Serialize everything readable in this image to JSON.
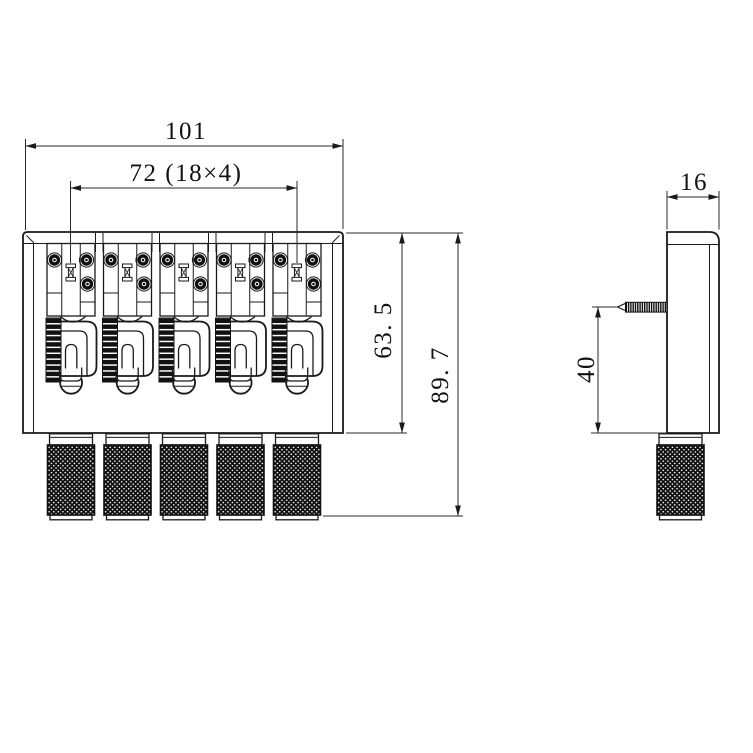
{
  "drawing": {
    "description": "Dimensioned engineering drawing of a 5-string bass guitar bridge, front and side orthographic views",
    "background_color": "#ffffff",
    "line_color": "#1a1a1a",
    "front_view": {
      "name": "front-view",
      "saddle_count": 5,
      "knob_count": 5,
      "dim_total_width": "101",
      "dim_saddle_spacing": "72 (18×4)",
      "dim_plate_height": "63. 5",
      "dim_overall_height": "89. 7"
    },
    "side_view": {
      "name": "side-view",
      "knob_count": 1,
      "dim_width": "16",
      "dim_screw_height": "40"
    }
  }
}
